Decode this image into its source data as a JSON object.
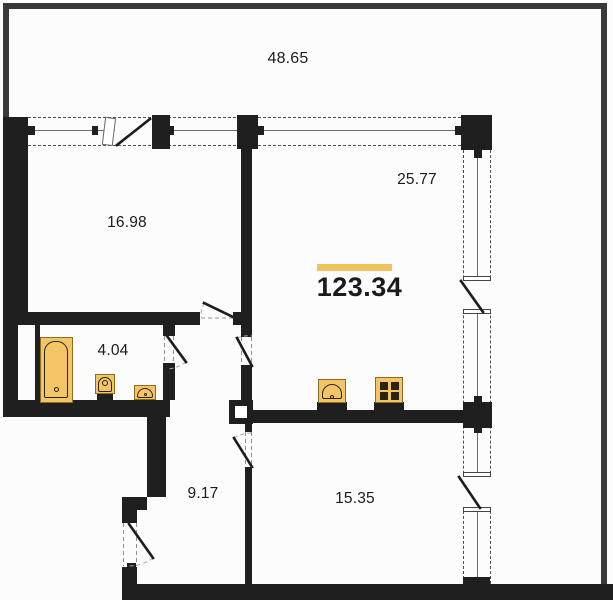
{
  "plan": {
    "type": "apartment-floor-plan",
    "total": {
      "value": "123.34"
    },
    "areas": {
      "terrace": "48.65",
      "bedroom": "16.98",
      "living_kitchen": "25.77",
      "bathroom": "4.04",
      "hallway": "9.17",
      "bedroom_2": "15.35"
    },
    "fixtures": [
      "bathtub",
      "toilet",
      "washbasin",
      "kitchen-sink",
      "stove"
    ],
    "features": [
      "window-band-top",
      "window-band-right",
      "balcony-doors",
      "entrance-door",
      "ventilation-shaft"
    ]
  },
  "colors": {
    "bg": "#fcfcfc",
    "wall": "#1f1f1f",
    "outer_wall": "#383838",
    "window_line": "#6b6b6b",
    "dash": "#4f4f4f",
    "fixture_fill": "#f4c566",
    "fixture_border": "#8a6d1f",
    "fixture_dark": "#2b2416",
    "accent_bar": "#eec25c",
    "text": "#1b1b1b",
    "arc": "#a9a9a9"
  }
}
